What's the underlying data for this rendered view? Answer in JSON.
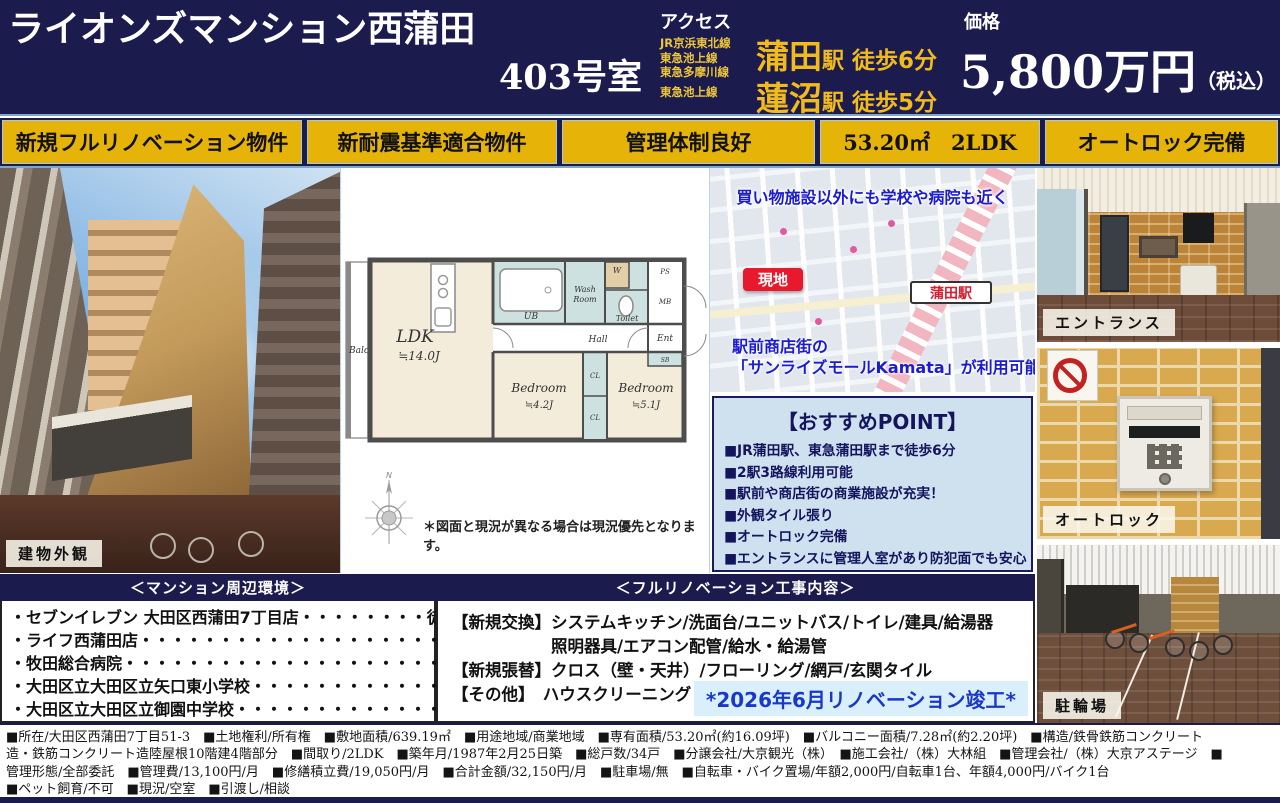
{
  "header": {
    "title_line1": "ライオンズマンション西蒲田",
    "title_line2": "403号室",
    "access_label": "アクセス",
    "rail_lines": [
      "JR京浜東北線",
      "東急池上線",
      "東急多摩川線",
      "東急池上線"
    ],
    "stations": [
      {
        "name": "蒲田",
        "station_suffix": "駅",
        "walk": "徒歩6分"
      },
      {
        "name": "蓮沼",
        "station_suffix": "駅",
        "walk": "徒歩5分"
      }
    ],
    "price_label": "価格",
    "price_value": "5,800万円",
    "price_note": "（税込）"
  },
  "badges": [
    {
      "label": "新規フルリノベーション物件"
    },
    {
      "label": "新耐震基準適合物件"
    },
    {
      "label": "管理体制良好"
    },
    {
      "label": "53.20㎡　2LDK"
    },
    {
      "label": "オートロック完備"
    }
  ],
  "photos": {
    "exterior_label": "建物外観",
    "entrance_label": "エントランス",
    "autolock_label": "オートロック",
    "bicycle_label": "駐輪場"
  },
  "floorplan": {
    "balcony": "Balcony",
    "ldk": "LDK",
    "ldk_size": "≒14.0J",
    "bedroom1": "Bedroom",
    "bedroom1_size": "≒4.2J",
    "bedroom2": "Bedroom",
    "bedroom2_size": "≒5.1J",
    "ub": "UB",
    "wash_line1": "Wash",
    "wash_line2": "Room",
    "toilet": "Toilet",
    "hall": "Hall",
    "ent": "Ent",
    "cl1": "CL",
    "cl2": "CL",
    "w": "W",
    "ps": "PS",
    "mb": "MB",
    "sb": "SB",
    "north": "N",
    "note": "＊図面と現況が異なる場合は現況優先となります。"
  },
  "map": {
    "top_text": "買い物施設以外にも学校や病院も近く",
    "site_badge": "現地",
    "station_badge": "蒲田駅",
    "bottom_line1": "駅前商店街の",
    "bottom_line2": "「サンライズモールKamata」が利用可能！"
  },
  "point_box": {
    "title": "【おすすめPOINT】",
    "items": [
      "■JR蒲田駅、東急蒲田駅まで徒歩6分",
      "■2駅3路線利用可能",
      "■駅前や商店街の商業施設が充実！",
      "■外観タイル張り",
      "■オートロック完備",
      "■エントランスに管理人室があり防犯面でも安心"
    ]
  },
  "surroundings": {
    "header": "＜マンション周辺環境＞",
    "items": [
      "・セブンイレブン 大田区西蒲田7丁目店・・・・・・・・徒歩1分",
      "・ライフ西蒲田店・・・・・・・・・・・・・・・・・・・・・・・・・徒歩1分",
      "・牧田総合病院・・・・・・・・・・・・・・・・・・・・・・・・・・徒歩7分",
      "・大田区立大田区立矢口東小学校・・・・・・・・・・・・徒歩9分",
      "・大田区立大田区立御園中学校・・・・・・・・・・・・・徒歩3分"
    ]
  },
  "renovation": {
    "header": "＜フルリノベーション工事内容＞",
    "lines": [
      "【新規交換】システムキッチン/洗面台/ユニットバス/トイレ/建具/給湯器",
      "　　　　　　照明器具/エアコン配管/給水・給湯管",
      "【新規張替】クロス（壁・天井）/フローリング/網戸/玄関タイル",
      "【その他】　ハウスクリーニング"
    ],
    "completion": "*2026年6月リノベーション竣工*"
  },
  "footer": {
    "lines": [
      "■所在/大田区西蒲田7丁目51-3　■土地権利/所有権　■敷地面積/639.19㎡　■用途地域/商業地域　■専有面積/53.20㎡(約16.09坪)　■バルコニー面積/7.28㎡(約2.20坪)　■構造/鉄骨鉄筋コンクリート",
      "造・鉄筋コンクリート造陸屋根10階建4階部分　■間取り/2LDK　■築年月/1987年2月25日築　■総戸数/34戸　■分譲会社/大京観光（株）　■施工会社/（株）大林組　■管理会社/（株）大京アステージ　■",
      "管理形態/全部委託　■管理費/13,100円/月　■修繕積立費/19,050円/月　■合計金額/32,150円/月　■駐車場/無　■自転車・バイク置場/年額2,000円/自転車1台、年額4,000円/バイク1台",
      "■ペット飼育/不可　■現況/空室　■引渡し/相談"
    ]
  },
  "colors": {
    "navy": "#1b1b4e",
    "badge_gold": "#e6b408",
    "accent_yellow": "#f2bb1c",
    "point_box_bg": "#cfe0ef",
    "map_text_blue": "#1b1bd0",
    "site_badge_red": "#e8192c",
    "completion_blue": "#1a38c8",
    "completion_bg": "#d9effc"
  }
}
